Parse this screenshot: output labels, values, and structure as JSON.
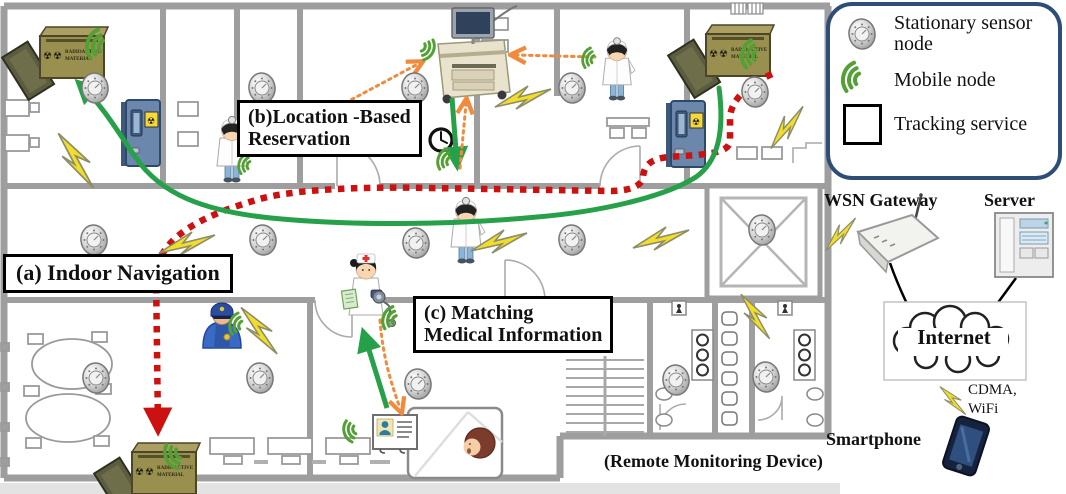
{
  "colors": {
    "accent_green": "#27a04a",
    "route_red": "#cc1111",
    "route_orange": "#f08a3c",
    "bolt_yellow": "#f2de2a",
    "legend_border": "#2e4d77",
    "wall_gray": "#9e9e9e",
    "box_olive": "#99904f",
    "door_blue": "#6b87ab"
  },
  "icons": {
    "radiation_symbol": "☢",
    "stationary_sensor": "round-detector",
    "mobile_node": "green-signal-arcs",
    "tracking_service": "white-square",
    "wireless_link": "lightning-bolt"
  },
  "legend": {
    "items": [
      {
        "icon": "stationary-sensor-icon",
        "label": "Stationary sensor node"
      },
      {
        "icon": "mobile-node-icon",
        "label": "Mobile node"
      },
      {
        "icon": "tracking-service-icon",
        "label": "Tracking service"
      }
    ]
  },
  "scenario_labels": {
    "a": "(a) Indoor Navigation",
    "b1": "(b)Location -Based",
    "b2": "Reservation",
    "c1": "(c) Matching",
    "c2": "Medical Information"
  },
  "network": {
    "gateway_label": "WSN Gateway",
    "server_label": "Server",
    "internet_label": "Internet",
    "link1": "CDMA,",
    "link2": "WiFi",
    "smartphone_label": "Smartphone",
    "smartphone_sublabel": "(Remote Monitoring Device)"
  },
  "radioactive_box": {
    "line1": "RADIOACTIVE",
    "line2": "MATERIAL"
  },
  "diagram": {
    "sensors": [
      [
        95,
        88
      ],
      [
        262,
        88
      ],
      [
        415,
        88
      ],
      [
        572,
        88
      ],
      [
        755,
        92
      ],
      [
        94,
        240
      ],
      [
        263,
        240
      ],
      [
        416,
        243
      ],
      [
        572,
        240
      ],
      [
        762,
        230
      ],
      [
        96,
        378
      ],
      [
        260,
        378
      ],
      [
        418,
        384
      ],
      [
        676,
        380
      ],
      [
        766,
        377
      ]
    ],
    "bolts": [
      [
        78,
        160,
        75,
        1.1
      ],
      [
        187,
        242,
        0,
        1
      ],
      [
        261,
        330,
        70,
        1
      ],
      [
        499,
        240,
        0,
        1
      ],
      [
        661,
        237,
        0,
        1
      ],
      [
        523,
        96,
        0,
        1
      ],
      [
        786,
        126,
        -35,
        0.9
      ],
      [
        757,
        316,
        75,
        0.9
      ],
      [
        840,
        233,
        -30,
        0.75
      ],
      [
        954,
        400,
        65,
        0.65
      ]
    ],
    "mobile_arcs": [
      [
        854,
        94,
        0,
        1
      ],
      [
        106,
        47,
        15,
        1
      ],
      [
        760,
        56,
        10,
        0.95
      ],
      [
        182,
        452,
        -25,
        0.9
      ],
      [
        252,
        166,
        15,
        0.7
      ],
      [
        596,
        60,
        15,
        0.7
      ],
      [
        452,
        162,
        20,
        0.75
      ],
      [
        244,
        326,
        15,
        0.75
      ],
      [
        398,
        321,
        20,
        0.8
      ],
      [
        358,
        429,
        -15,
        0.75
      ],
      [
        420,
        46,
        -155,
        0.75
      ]
    ],
    "routes": {
      "red": "M772,74 C750,84 731,98 730,118 L730,140 C730,152 712,153 698,155 L668,157 C651,159 644,165 643,177 C642,187 627,191 611,191 L430,188 C338,186 282,192 256,200 C213,213 162,232 156,272 L158,428",
      "green": "M719,88 C725,134 717,162 696,177 C663,198 597,212 537,217 C451,225 351,226 271,218 C203,211 161,194 136,158 C120,135 103,106 80,84",
      "green_arrow_cart_to_doctor": "M452,98 L457,164",
      "green_arrow_card_to_nurse": "M387,408 L364,334",
      "orange_doctor_to_cart": "M259,149 L418,64",
      "orange_doctor2_to_cart": "M595,57 L516,55",
      "orange_corridor_to_cart": "M460,168 L466,104",
      "orange_nurse_to_card": "M380,320 C383,360 392,385 400,408"
    }
  }
}
